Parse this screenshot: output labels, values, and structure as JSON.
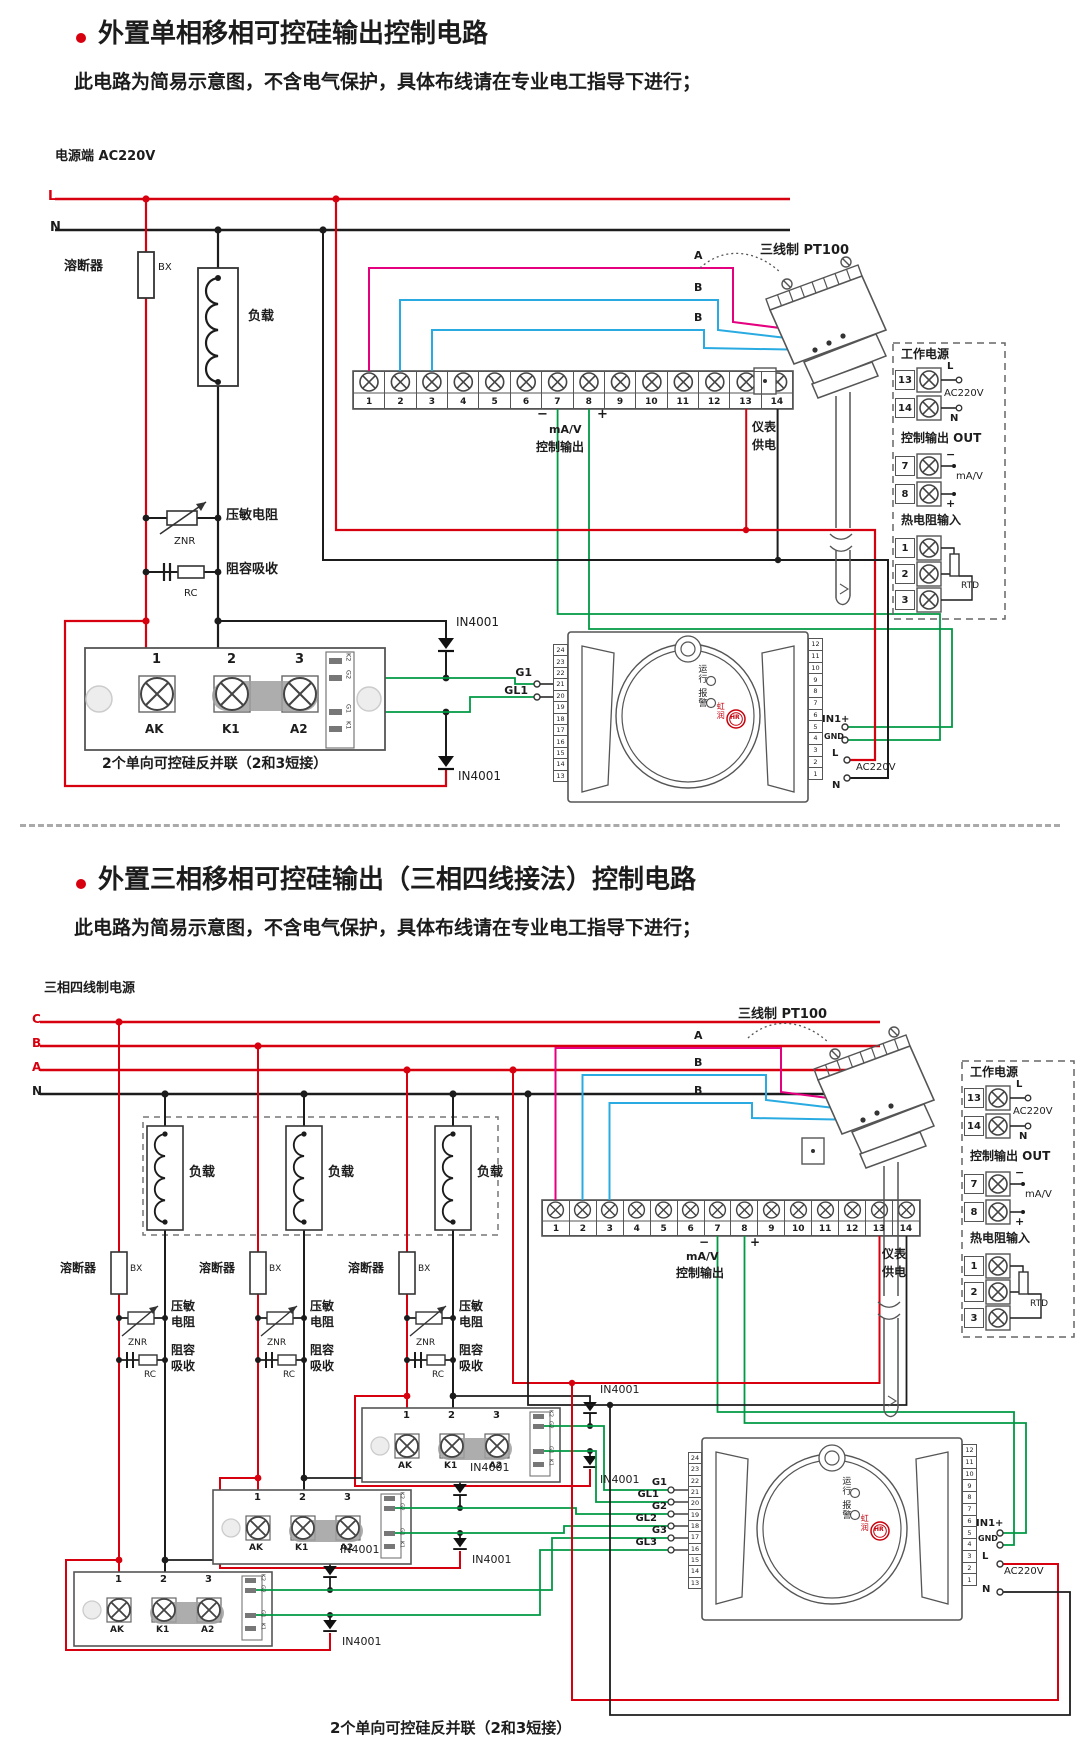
{
  "colors": {
    "accent_red": "#d7000f",
    "wire_magenta": "#e4007f",
    "wire_blue": "#29abe2",
    "wire_green": "#009944",
    "brand_red": "#c7000b"
  },
  "s1": {
    "title": "外置单相移相可控硅输出控制电路",
    "subtitle": "此电路为简易示意图，不含电气保护，具体布线请在专业电工指导下进行；",
    "power": "电源端  AC220V",
    "L": "L",
    "N": "N",
    "fuse": "溶断器",
    "bx": "BX",
    "load": "负载",
    "znr_label": "压敏电阻",
    "znr": "ZNR",
    "rc_label": "阻容吸收",
    "rc": "RC",
    "terminals": [
      "1",
      "2",
      "3",
      "4",
      "5",
      "6",
      "7",
      "8",
      "9",
      "10",
      "11",
      "12",
      "13",
      "14"
    ],
    "minus": "−",
    "plus": "+",
    "mav": "mA/V",
    "ctrl": "控制输出",
    "meter_sup1": "仪表",
    "meter_sup2": "供电",
    "pt100": "三线制 PT100",
    "wA": "A",
    "wB": "B",
    "scr": {
      "n": [
        "1",
        "2",
        "3"
      ],
      "b": [
        "AK",
        "K1",
        "A2"
      ],
      "side": [
        "K2",
        "G2",
        "G1",
        "K1"
      ]
    },
    "in4001": "IN4001",
    "caption": "2个单向可控硅反并联（2和3短接）",
    "g1": "G1",
    "gl1": "GL1",
    "meter": {
      "left": [
        "24",
        "23",
        "22",
        "21",
        "20",
        "19",
        "18",
        "17",
        "16",
        "15",
        "14",
        "13"
      ],
      "right": [
        "12",
        "11",
        "10",
        "9",
        "8",
        "7",
        "6",
        "5",
        "4",
        "3",
        "2",
        "1"
      ],
      "run": "运行",
      "alarm": "报警",
      "brand": "虹润",
      "logo": "HR",
      "in1": "IN1+",
      "gnd": "GND",
      "L": "L",
      "N": "N",
      "ac": "AC220V"
    },
    "panel": {
      "power_title": "工作电源",
      "n13": "13",
      "n14": "14",
      "L": "L",
      "N": "N",
      "ac": "AC220V",
      "out_title": "控制输出 OUT",
      "n7": "7",
      "n8": "8",
      "minus": "−",
      "plus": "+",
      "mav": "mA/V",
      "rtd_title": "热电阻输入",
      "n1": "1",
      "n2": "2",
      "n3": "3",
      "rtd": "RTD"
    }
  },
  "s2": {
    "title": "外置三相移相可控硅输出（三相四线接法）控制电路",
    "subtitle": "此电路为简易示意图，不含电气保护，具体布线请在专业电工指导下进行；",
    "power": "三相四线制电源",
    "C": "C",
    "B": "B",
    "A": "A",
    "N": "N",
    "fuse": "溶断器",
    "bx": "BX",
    "load": "负载",
    "znr2": [
      "压敏",
      "电阻"
    ],
    "rc2": [
      "阻容",
      "吸收"
    ],
    "znr": "ZNR",
    "rc": "RC",
    "terminals": [
      "1",
      "2",
      "3",
      "4",
      "5",
      "6",
      "7",
      "8",
      "9",
      "10",
      "11",
      "12",
      "13",
      "14"
    ],
    "minus": "−",
    "plus": "+",
    "mav": "mA/V",
    "ctrl": "控制输出",
    "meter_sup1": "仪表",
    "meter_sup2": "供电",
    "pt100": "三线制 PT100",
    "wA": "A",
    "wB": "B",
    "scr": {
      "n": [
        "1",
        "2",
        "3"
      ],
      "b": [
        "AK",
        "K1",
        "A2"
      ],
      "side": [
        "K2",
        "G2",
        "G1",
        "K1"
      ]
    },
    "in4001": "IN4001",
    "g": [
      "G1",
      "GL1",
      "G2",
      "GL2",
      "G3",
      "GL3"
    ],
    "caption": "2个单向可控硅反并联（2和3短接）",
    "meter": {
      "left": [
        "24",
        "23",
        "22",
        "21",
        "20",
        "19",
        "18",
        "17",
        "16",
        "15",
        "14",
        "13"
      ],
      "right": [
        "12",
        "11",
        "10",
        "9",
        "8",
        "7",
        "6",
        "5",
        "4",
        "3",
        "2",
        "1"
      ],
      "run": "运行",
      "alarm": "报警",
      "brand": "虹润",
      "logo": "HR",
      "in1": "IN1+",
      "gnd": "GND",
      "L": "L",
      "N": "N",
      "ac": "AC220V"
    },
    "panel": {
      "power_title": "工作电源",
      "n13": "13",
      "n14": "14",
      "L": "L",
      "N": "N",
      "ac": "AC220V",
      "out_title": "控制输出 OUT",
      "n7": "7",
      "n8": "8",
      "minus": "−",
      "plus": "+",
      "mav": "mA/V",
      "rtd_title": "热电阻输入",
      "n1": "1",
      "n2": "2",
      "n3": "3",
      "rtd": "RTD"
    }
  }
}
